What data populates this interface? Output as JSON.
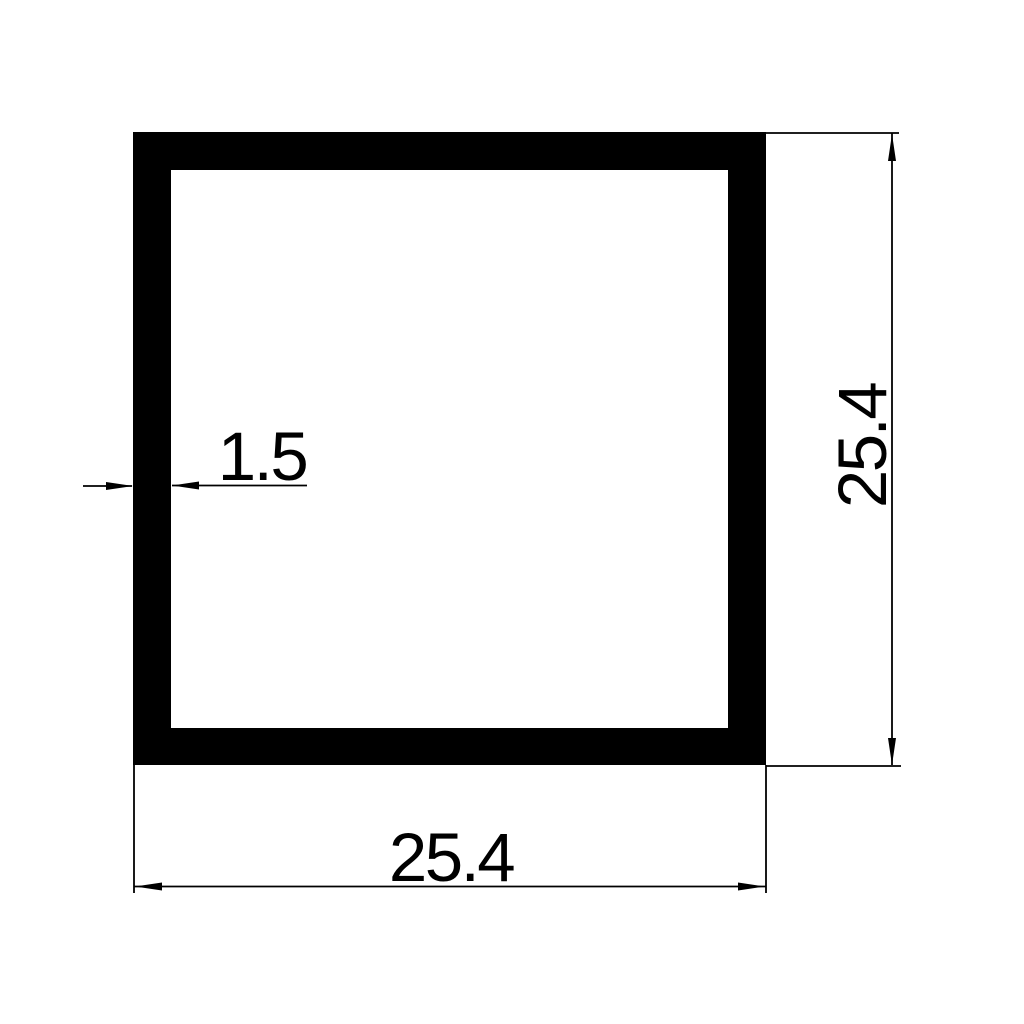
{
  "drawing": {
    "colors": {
      "ink": "#000000",
      "background": "#ffffff"
    },
    "labels": {
      "outer_width": "25.4",
      "outer_height": "25.4",
      "wall_thickness": "1.5"
    }
  }
}
